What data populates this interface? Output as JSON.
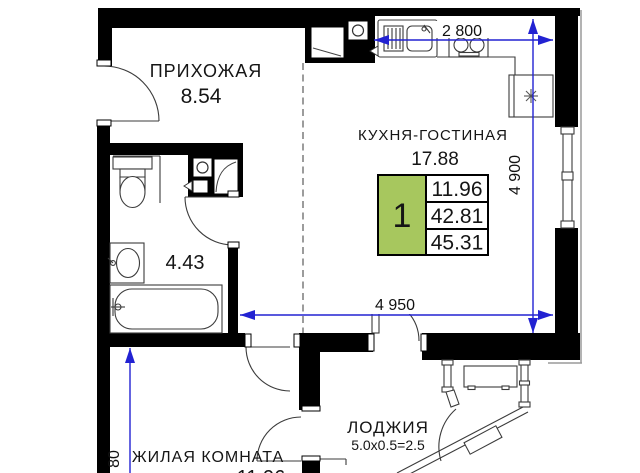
{
  "plan": {
    "type": "apartment-floor-plan",
    "rooms": {
      "hallway": {
        "name": "ПРИХОЖАЯ",
        "area": "8.54"
      },
      "kitchen_living": {
        "name": "КУХНЯ-ГОСТИНАЯ",
        "area": "17.88"
      },
      "bathroom": {
        "area": "4.43"
      },
      "living_room": {
        "name": "ЖИЛАЯ КОМНАТА",
        "area": "11.96"
      },
      "loggia": {
        "name": "ЛОДЖИЯ",
        "area_formula": "5.0x0.5=2.5"
      }
    },
    "info_table": {
      "rooms_count": "1",
      "living_area": "11.96",
      "area_no_loggia": "42.81",
      "total_area": "45.31"
    },
    "dimensions": {
      "kitchen_width_mm": "2 800",
      "kitchen_depth_mm": "4 900",
      "apartment_width_mm": "4 950",
      "left_dim_partial": "80"
    },
    "colors": {
      "wall": "#000000",
      "dimension": "#2222d2",
      "table_green": "#a7c75e"
    }
  }
}
